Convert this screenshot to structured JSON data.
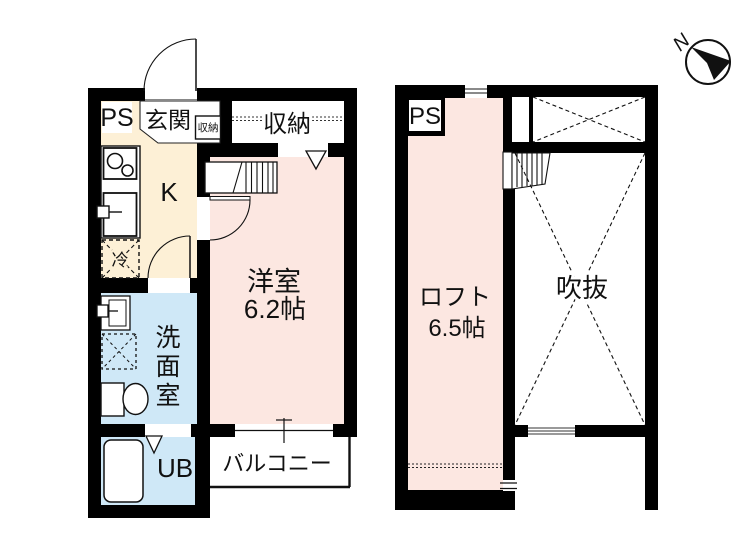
{
  "colors": {
    "wall": "#000000",
    "room_pink": "#fce7e1",
    "kitchen_cream": "#fdf0d6",
    "wet_blue": "#cfe8f7",
    "white": "#ffffff"
  },
  "floor1": {
    "ps_label": "PS",
    "entrance_label": "玄関",
    "entrance_storage_label": "収納",
    "closet_label": "収納",
    "kitchen_label": "K",
    "fridge_label": "冷",
    "room_label": "洋室",
    "room_size_label": "6.2帖",
    "washroom_chars": [
      "洗",
      "面",
      "室"
    ],
    "unit_bath_label": "UB",
    "balcony_label": "バルコニー"
  },
  "floor2": {
    "ps_label": "PS",
    "loft_label": "ロフト",
    "loft_size_label": "6.5帖",
    "void_label": "吹抜"
  },
  "compass": {
    "north_label": "N"
  }
}
